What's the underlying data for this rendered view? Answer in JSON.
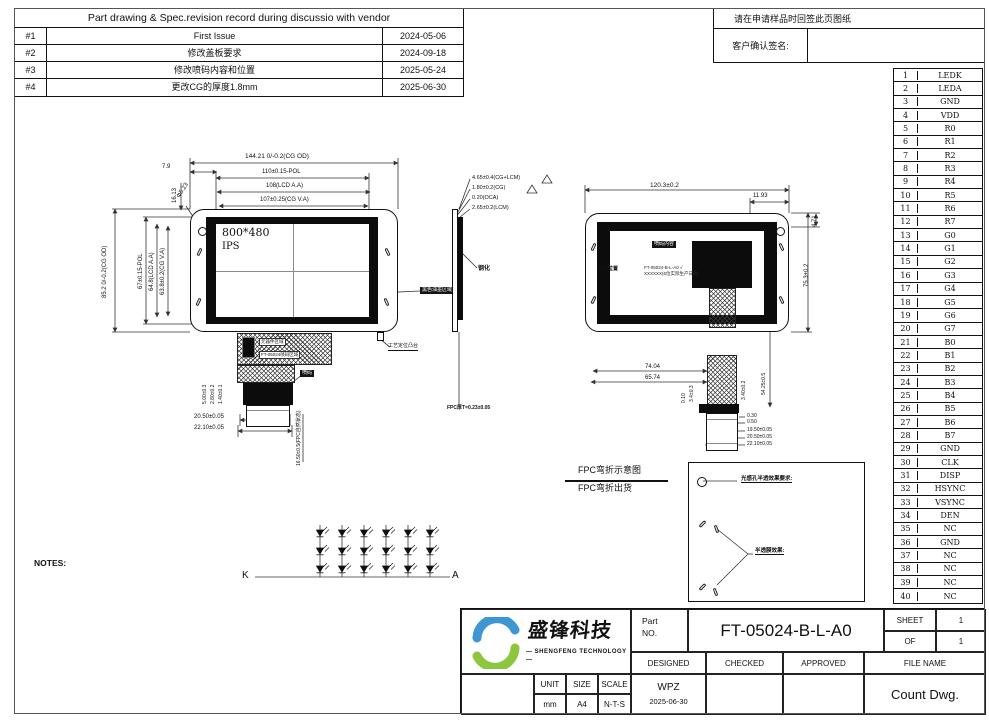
{
  "revision_table": {
    "title": "Part drawing & Spec.revision record during discussio with vendor",
    "rows": [
      {
        "no": "#1",
        "desc": "First Issue",
        "date": "2024-05-06"
      },
      {
        "no": "#2",
        "desc": "修改盖板要求",
        "date": "2024-09-18"
      },
      {
        "no": "#3",
        "desc": "修改喷码内容和位置",
        "date": "2025-05-24"
      },
      {
        "no": "#4",
        "desc": "更改CG的厚度1.8mm",
        "date": "2025-06-30"
      }
    ]
  },
  "signoff": {
    "notice": "请在申请样品时回签此页图纸",
    "label": "客户确认签名:"
  },
  "pin_table": {
    "pins": [
      {
        "no": "1",
        "name": "LEDK"
      },
      {
        "no": "2",
        "name": "LEDA"
      },
      {
        "no": "3",
        "name": "GND"
      },
      {
        "no": "4",
        "name": "VDD"
      },
      {
        "no": "5",
        "name": "R0"
      },
      {
        "no": "6",
        "name": "R1"
      },
      {
        "no": "7",
        "name": "R2"
      },
      {
        "no": "8",
        "name": "R3"
      },
      {
        "no": "9",
        "name": "R4"
      },
      {
        "no": "10",
        "name": "R5"
      },
      {
        "no": "11",
        "name": "R6"
      },
      {
        "no": "12",
        "name": "R7"
      },
      {
        "no": "13",
        "name": "G0"
      },
      {
        "no": "14",
        "name": "G1"
      },
      {
        "no": "15",
        "name": "G2"
      },
      {
        "no": "16",
        "name": "G3"
      },
      {
        "no": "17",
        "name": "G4"
      },
      {
        "no": "18",
        "name": "G5"
      },
      {
        "no": "19",
        "name": "G6"
      },
      {
        "no": "20",
        "name": "G7"
      },
      {
        "no": "21",
        "name": "B0"
      },
      {
        "no": "22",
        "name": "B1"
      },
      {
        "no": "23",
        "name": "B2"
      },
      {
        "no": "24",
        "name": "B3"
      },
      {
        "no": "25",
        "name": "B4"
      },
      {
        "no": "26",
        "name": "B5"
      },
      {
        "no": "27",
        "name": "B6"
      },
      {
        "no": "28",
        "name": "B7"
      },
      {
        "no": "29",
        "name": "GND"
      },
      {
        "no": "30",
        "name": "CLK"
      },
      {
        "no": "31",
        "name": "DISP"
      },
      {
        "no": "32",
        "name": "HSYNC"
      },
      {
        "no": "33",
        "name": "VSYNC"
      },
      {
        "no": "34",
        "name": "DEN"
      },
      {
        "no": "35",
        "name": "NC"
      },
      {
        "no": "36",
        "name": "GND"
      },
      {
        "no": "37",
        "name": "NC"
      },
      {
        "no": "38",
        "name": "NC"
      },
      {
        "no": "39",
        "name": "NC"
      },
      {
        "no": "40",
        "name": "NC"
      }
    ]
  },
  "front_view": {
    "screen_resolution": "800*480",
    "panel_type": "IPS",
    "dim_cg_od_w": "144.21 0/-0.2(CG OD)",
    "dim_pol_w": "110±0.15-POL",
    "dim_lcd_aa_w": "108(LCD A.A)",
    "dim_cg_va_w": "107±0.25(CG V.A)",
    "dim_cg_od_h": "85.2 0/-0.2(CG OD)",
    "dim_pol_h": "67±0.15-POL",
    "dim_lcd_aa_h": "64.8(LCD A.A)",
    "dim_cg_va_h": "63.8±0.2(CG V.A)",
    "dim_edge": "7.9",
    "dim_hole_y": "16.13",
    "dim_hole_d": "Φ5.23",
    "callout_ink": "黑色油墨区域",
    "callout_tab": "工艺定位凸台",
    "callout_code": "喷码",
    "fpc_label_components": "元器件区域",
    "fpc_label_code": "FT-05024喷码区域",
    "dim_fpc_1": "5.00±0.3",
    "dim_fpc_2": "2.80±0.2",
    "dim_fpc_3": "1.40±0.1",
    "dim_conn_w1": "20.50±0.05",
    "dim_conn_w2": "22.10±0.05",
    "dim_fpc_len": "16.50±0.5(FPC自然状态)"
  },
  "side_view": {
    "dim_total": "4.65±0.4(CG+LCM)",
    "dim_cg": "1.80±0.2(CG)",
    "dim_oca": "0.20(OCA)",
    "dim_lcm": "2.65±0.2(LCM)",
    "label_tempered": "钢化",
    "dim_fpc_t": "FPC厚T=0.23±0.05"
  },
  "rear_view": {
    "dim_w": "120.3±0.2",
    "dim_offset": "11.93",
    "dim_corner": "4.71",
    "dim_h": "75.3±0.2",
    "dim_74": "74.04",
    "dim_65": "65.74",
    "dim_54": "54.25±0.5",
    "dim_3_40": "3.40±0.2",
    "dim_3_4": "3.4±0.3",
    "dim_0_10": "0.10",
    "dim_0_30": "0.30",
    "dim_0_50": "0.50",
    "dim_19_50": "19.50±0.05",
    "dim_20_50": "20.50±0.05",
    "dim_22_10": "22.10±0.05",
    "callout_code_content": "喷码内容",
    "callout_code_pos": "喷码位置",
    "code_line1": "FT-05024-B-L-A0 √",
    "code_line2": "XXXXXX(6位实际生产日期)"
  },
  "fpc_bend": {
    "label1": "FPC弯折示意图",
    "label2": "FPC弯折出货"
  },
  "detail_box": {
    "title1": "光感孔半透效果要求:",
    "lines1": [
      {
        "t": "不点亮看不见, 点亮看到"
      },
      {
        "t": "透过率白光波550NM/10±5%"
      },
      {
        "t": "透过率红光波950NM/≥75%"
      }
    ],
    "title2": "半透膜效果:",
    "lines2": [
      {
        "t": "透过率白光波长550NM  1.5%-3.2%"
      },
      {
        "t": "透过率红光波长850NM  35%~55%"
      }
    ]
  },
  "led_circuit": {
    "cathode": "K",
    "anode": "A"
  },
  "notes": {
    "title": "NOTES:",
    "lines": [
      {
        "t": "1.DISPLAY TYPE:BOE5″,TFT;"
      },
      {
        "t": "2.VIEWING DIRECTION :ALL;"
      },
      {
        "t": "3.Driver IC:ST7265;"
      },
      {
        "t": "4.STORAGE TEMPERATURE:-35° C TO 85° C,"
      },
      {
        "t": "  OPERATING TEMPERATURE:-30° C TO 85° C;"
      },
      {
        "t": "5.BL LIGHT:18 LED, If=120mA/LED,16.2~19.8V"
      },
      {
        "t": "6.均匀性 >80%;"
      },
      {
        "t": "7.GENERAL TOLERANCE:±0.2mm;"
      },
      {
        "t": "8.RoHS 2.0;"
      },
      {
        "t": "9.平面翘曲度公差:≤0.3MM;"
      }
    ]
  },
  "title_block": {
    "company_cn": "盛锋科技",
    "company_en": "— SHENGFENG TECHNOLOGY —",
    "part_label_1": "Part",
    "part_label_2": "NO.",
    "part_no": "FT-05024-B-L-A0",
    "sheet_label": "SHEET",
    "sheet_value": "1",
    "of_label": "OF",
    "of_value": "1",
    "designed_label": "DESIGNED",
    "checked_label": "CHECKED",
    "approved_label": "APPROVED",
    "file_name_label": "FILE NAME",
    "designed_value": "WPZ",
    "designed_date": "2025-06-30",
    "file_name_value": "Count Dwg.",
    "unit_label": "UNIT",
    "unit_value": "mm",
    "size_label": "SIZE",
    "size_value": "A4",
    "scale_label": "SCALE",
    "scale_value": "N-T-S"
  }
}
